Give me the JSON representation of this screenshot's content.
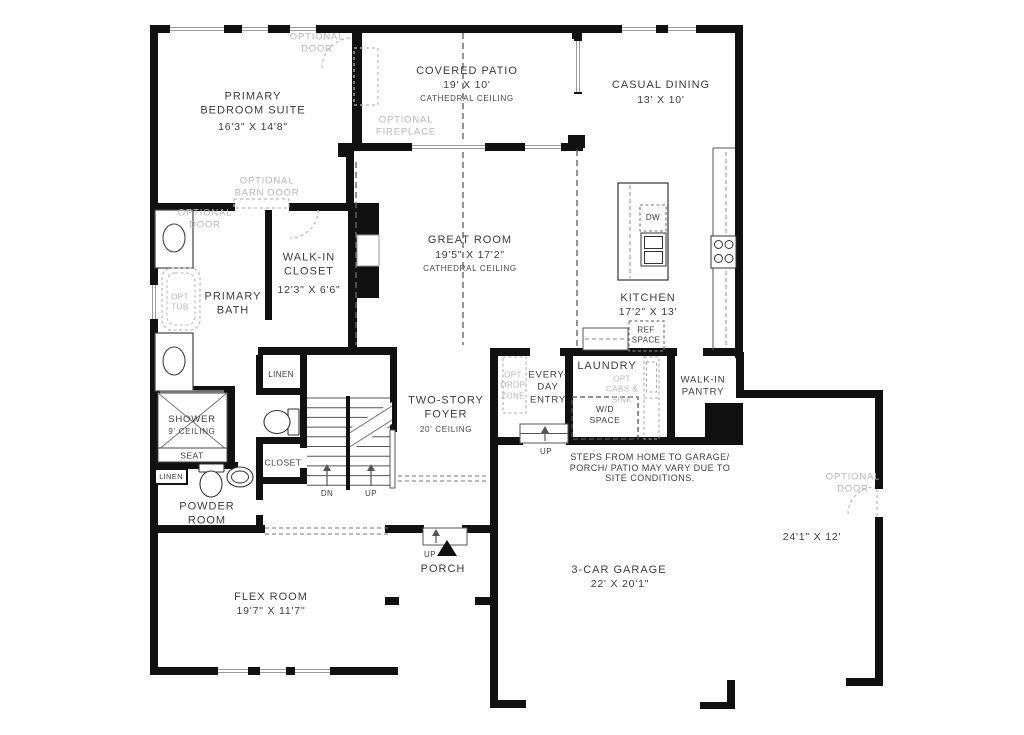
{
  "rooms": {
    "primary_bedroom": {
      "name": "PRIMARY BEDROOM SUITE",
      "dims": "16'3\" X 14'8\""
    },
    "covered_patio": {
      "name": "COVERED PATIO",
      "dims": "19' X 10'",
      "ceiling": "CATHEDRAL CEILING"
    },
    "casual_dining": {
      "name": "CASUAL DINING",
      "dims": "13' X 10'"
    },
    "great_room": {
      "name": "GREAT ROOM",
      "dims": "19'5\" X 17'2\"",
      "ceiling": "CATHEDRAL CEILING"
    },
    "walk_in_closet": {
      "name": "WALK-IN CLOSET",
      "dims": "12'3\" X 6'6\""
    },
    "primary_bath": {
      "name": "PRIMARY BATH"
    },
    "kitchen": {
      "name": "KITCHEN",
      "dims": "17'2\" X 13'"
    },
    "laundry": {
      "name": "LAUNDRY"
    },
    "walk_in_pantry": {
      "name": "WALK-IN PANTRY"
    },
    "everyday_entry": {
      "name": "EVERY-DAY ENTRY"
    },
    "two_story_foyer": {
      "name": "TWO-STORY FOYER",
      "ceiling": "20' CEILING"
    },
    "shower": {
      "name": "SHOWER",
      "ceiling": "9' CEILING",
      "seat": "SEAT"
    },
    "powder_room": {
      "name": "POWDER ROOM"
    },
    "flex_room": {
      "name": "FLEX ROOM",
      "dims": "19'7\" X 11'7\""
    },
    "porch": {
      "name": "PORCH"
    },
    "garage": {
      "name": "3-CAR GARAGE",
      "dims": "22' X 20'1\""
    },
    "garage_bay": {
      "dims": "24'1\" X 12'"
    }
  },
  "optional": {
    "bedroom_door": "OPTIONAL DOOR",
    "fireplace": "OPTIONAL FIREPLACE",
    "barn_door": "OPTIONAL BARN DOOR",
    "bath_door": "OPTIONAL DOOR",
    "tub": "OPT TUB",
    "drop_zone": "OPT DROP ZONE",
    "cabs_sink": "OPT CABS & SINK",
    "garage_door": "OPTIONAL DOOR"
  },
  "closets": {
    "linen_hall": "LINEN",
    "linen_powder": "LINEN",
    "hall_closet": "CLOSET"
  },
  "appliances": {
    "dishwasher": "DW",
    "ref_space": "REF SPACE",
    "wd_space": "W/D SPACE"
  },
  "stairs": {
    "down": "DN",
    "up": "UP"
  },
  "steps": {
    "entry_up": "UP",
    "porch_up": "UP"
  },
  "notes": {
    "site": "STEPS FROM HOME TO GARAGE/ PORCH/ PATIO MAY VARY DUE TO SITE CONDITIONS."
  },
  "colors": {
    "wall": "#111111",
    "optional_gray": "#b7b7b7",
    "label": "#3d3d3d"
  }
}
